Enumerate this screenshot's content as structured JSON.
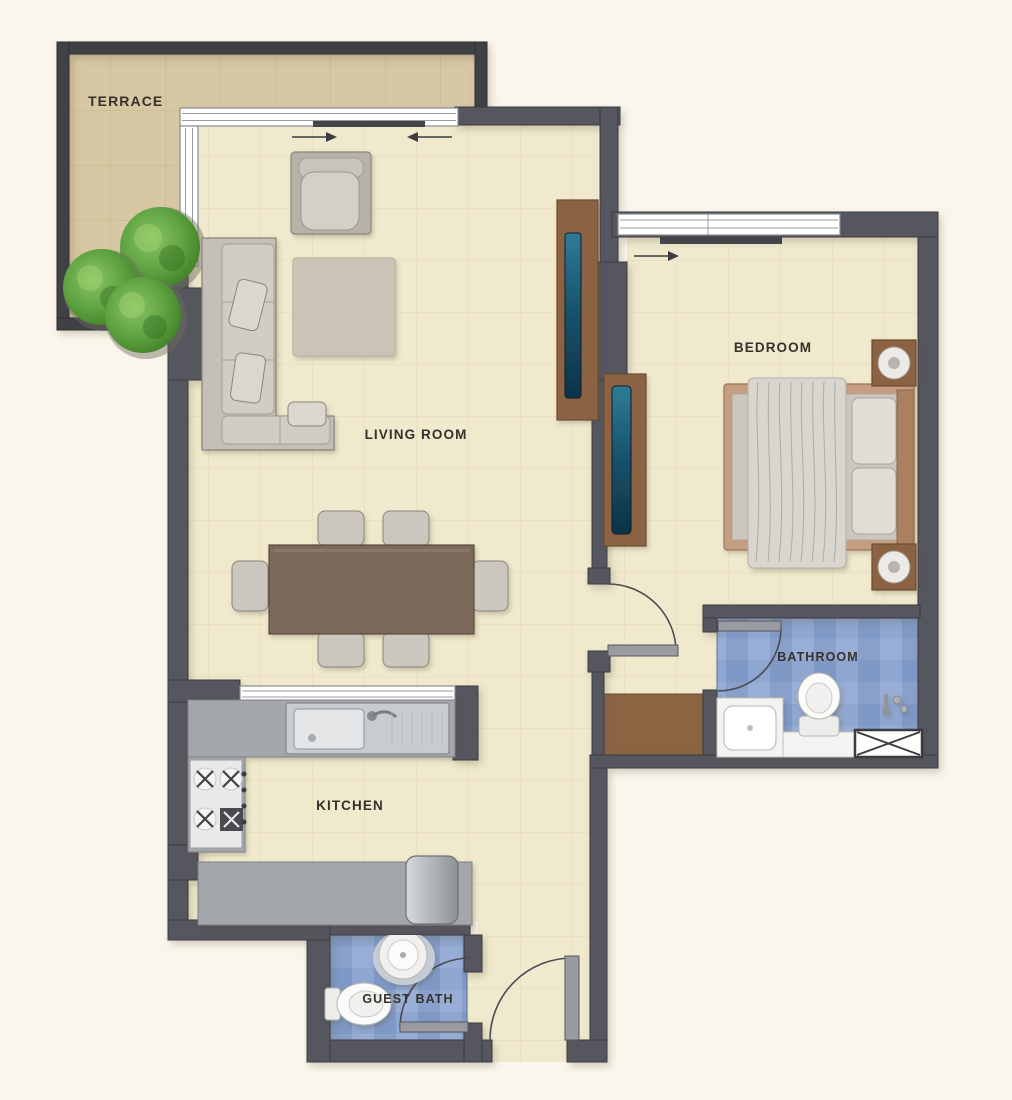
{
  "title": "One-bedroom apartment floor plan",
  "rooms": {
    "terrace": {
      "label": "TERRACE"
    },
    "living_room": {
      "label": "LIVING ROOM"
    },
    "bedroom": {
      "label": "BEDROOM"
    },
    "bathroom": {
      "label": "BATHROOM"
    },
    "kitchen": {
      "label": "KITCHEN"
    },
    "guest_bath": {
      "label": "GUEST BATH"
    }
  },
  "colors": {
    "background": "#fbf6ec",
    "wall": "#56565e",
    "wall_dark": "#404046",
    "floor_cream": "#f0e9cd",
    "floor_cream_line": "#ded3ae",
    "floor_terrace": "#d7c7a2",
    "floor_terrace_line": "#c3b189",
    "tile_blue_a": "#8fa7d0",
    "tile_blue_b": "#7f99c6",
    "tile_blue_c": "#98aed6",
    "tile_blue_d": "#88a0ca",
    "wood_brown": "#8b6442",
    "teal_tv": "#1d5a74",
    "sofa_gray": "#c5c0b7",
    "counter_gray": "#a3a6aa",
    "label_text": "#36302a",
    "plant_green": "#53933a"
  }
}
